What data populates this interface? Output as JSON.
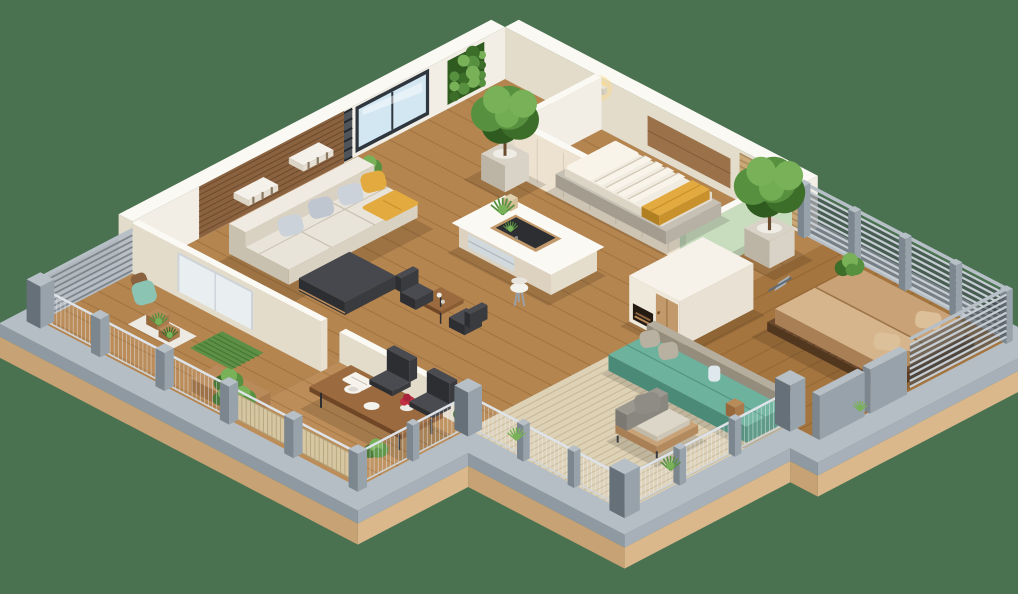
{
  "meta": {
    "title": "3D isometric apartment floor plan render",
    "canvas": {
      "width": 1018,
      "height": 594
    }
  },
  "background": "#4a7150",
  "palette": {
    "slabGrayTop": "#b5bec5",
    "slabGrayR": "#a7b0b8",
    "slabGrayL": "#8f99a2",
    "baseTanR": "#dbb88c",
    "baseTanL": "#c6a274",
    "floorWood": "#b5854f",
    "floorWoodDark": "#a5753f",
    "plankLine": "#6e4a22",
    "deckWood": "#bc8d58",
    "terraceMat": "#ddd1b6",
    "terraceMatLine": "#c3b391",
    "wallTop": "#fbf9f3",
    "wallR": "#f2eee5",
    "wallL": "#e3dccb",
    "wallCream": "#ece2cf",
    "wallSeam": "#d8cdb6",
    "mint": "#c8dcbe",
    "mintEnd": "#b8cdb0",
    "woodWall": "#8a6240",
    "woodWallLine": "#6f4c2e",
    "headboard": "#9a7148",
    "woodSlatLight": "#c9a875",
    "woodSlatLine": "#a8885a",
    "glass": "#d3e7f3",
    "glassFrame": "#2f363d",
    "glassLite": "#e9f0f4",
    "metalLight": "#b7c0c7",
    "metal": "#98a2ab",
    "metalDark": "#7c868f",
    "metalDarker": "#667079",
    "slatDark": "#31373d",
    "slatLight": "#c6cdd3",
    "meshLine": "#eef2f6",
    "railTop": "#dde3e8",
    "beigeSlat": "#d8c9a6",
    "beigeSlatLine": "#b1a077",
    "sofa": "#e9e4da",
    "sofaSide": "#d9d2c3",
    "sofaDark": "#c9c1af",
    "pillowGray1": "#ccd2da",
    "pillowGray2": "#bfc6cf",
    "yellow": "#e3ab3f",
    "yellowDark": "#c8912c",
    "charcoal": "#3a3b3f",
    "charcoalLight": "#4a4b50",
    "charcoalDark": "#2d2e32",
    "stone": "#b7b0a4",
    "stoneLight": "#c6c0b5",
    "mattress": "#f1ece1",
    "duvet": "#f8f4ea",
    "tan": "#c9a377",
    "tanLight": "#d6b58c",
    "tanDark": "#b28a5e",
    "bedSlatWood": "#6b4a2e",
    "bedSlatLine": "#52371f",
    "teal": "#6cb29d",
    "tealDark": "#549480",
    "tealLight": "#8cc4b4",
    "concrete": "#a8a192",
    "concreteDark": "#948d7d",
    "woodTable": "#8a5c34",
    "woodTableTop": "#9b6b3f",
    "woodTableDark": "#6f4727",
    "red": "#c22f42",
    "green": "#579140",
    "greenLight": "#78b157",
    "greenDark": "#3c6e2a",
    "greenDeep": "#2f5a20",
    "pot": "#d9d3c7",
    "potDark": "#bcb4a4",
    "potTan": "#b98a5a",
    "fireplaceVoid": "#241a12",
    "doorWood": "#c2996a",
    "glow": "#ffd978",
    "shadow": "rgba(0,0,0,0.13)"
  },
  "rooms": [
    {
      "id": "living-room",
      "label": "Living room with sofa and wood accent wall"
    },
    {
      "id": "small-bedroom",
      "label": "Small bedroom with bed and wall lamp"
    },
    {
      "id": "kitchen",
      "label": "Kitchen with island and bar stool"
    },
    {
      "id": "master-bedroom",
      "label": "Master bedroom with platform bed"
    },
    {
      "id": "dining-deck",
      "label": "Dining terrace with wooden table"
    },
    {
      "id": "lounge-terrace",
      "label": "Lounge terrace with armchair and daybed"
    },
    {
      "id": "side-balcony",
      "label": "Side balcony with potted plants"
    }
  ],
  "inventory": {
    "base": {
      "label": "Base platform slab"
    },
    "floors": {
      "label": "Wood plank flooring"
    },
    "wall-left": {
      "label": "North-west wall with window, vertical garden and wood accent panel"
    },
    "wall-top": {
      "label": "North-east wall with wall lamp and headboard panel"
    },
    "slat-railing": {
      "label": "Slatted privacy railing"
    },
    "bedroom-walls": {
      "label": "Small bedroom partition walls with mint accent"
    },
    "bed-small": {
      "label": "Bed with striped duvet and yellow blanket"
    },
    "wall-lamp": {
      "label": "Glowing wall sconce"
    },
    "tree-left": {
      "label": "Potted tree in white planter"
    },
    "tree-right": {
      "label": "Potted tree beside master bedroom"
    },
    "kitchen-island": {
      "label": "Kitchen island with cooktop"
    },
    "bar-stool": {
      "label": "White bar stool"
    },
    "sofa": {
      "label": "Cream sofa with gray and yellow pillows"
    },
    "ottoman": {
      "label": "Dark ottoman"
    },
    "cafe-set": {
      "label": "Small table with two chairs"
    },
    "fireplace": {
      "label": "Fireplace and wardrobe unit"
    },
    "master-bed": {
      "label": "Master platform bed with tan mattress"
    },
    "lounge-chair": {
      "label": "Lounge chair"
    },
    "daybed": {
      "label": "Teal daybed against concrete wall"
    },
    "armchair": {
      "label": "Wooden armchair with gray cushions"
    },
    "dining-set": {
      "label": "Dining table with chairs, plates and red flowers"
    },
    "deck-plants": {
      "label": "Planter boxes and shrubs"
    },
    "balcony-items": {
      "label": "Balcony plants, mat and teal cushion"
    },
    "mesh-railing": {
      "label": "Wire mesh railing with posts"
    },
    "deck-railing": {
      "label": "Beige slatted deck railing"
    },
    "panels-right": {
      "label": "Gray privacy panels"
    }
  }
}
